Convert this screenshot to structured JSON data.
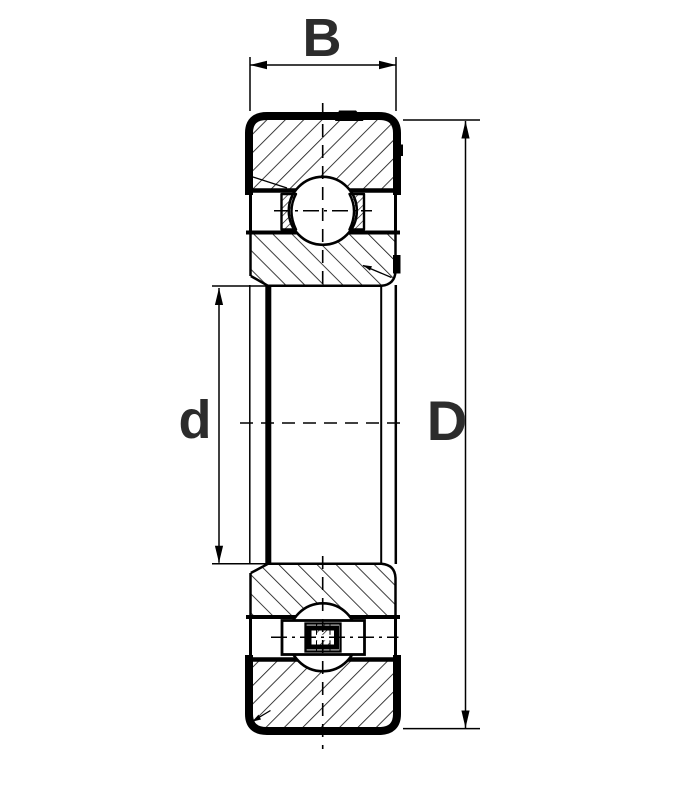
{
  "diagram": {
    "kind": "bearing-cross-section",
    "description": "Deep groove ball bearing technical cross-section drawing",
    "labels": {
      "width": "B",
      "bore": "d",
      "outer_diameter": "D"
    },
    "parts": [
      {
        "name": "outer-ring-top-section"
      },
      {
        "name": "inner-ring-top-section"
      },
      {
        "name": "ball-top"
      },
      {
        "name": "cage-pocket-left"
      },
      {
        "name": "cage-pocket-right"
      },
      {
        "name": "bore"
      },
      {
        "name": "inner-ring-bottom-section"
      },
      {
        "name": "ball-bottom"
      },
      {
        "name": "riveted-cage"
      },
      {
        "name": "outer-ring-bottom-section"
      }
    ],
    "colors": {
      "line": "#000000",
      "hatch": "#1a1a1a",
      "label": "#2c2c2c",
      "background": "#ffffff"
    }
  }
}
